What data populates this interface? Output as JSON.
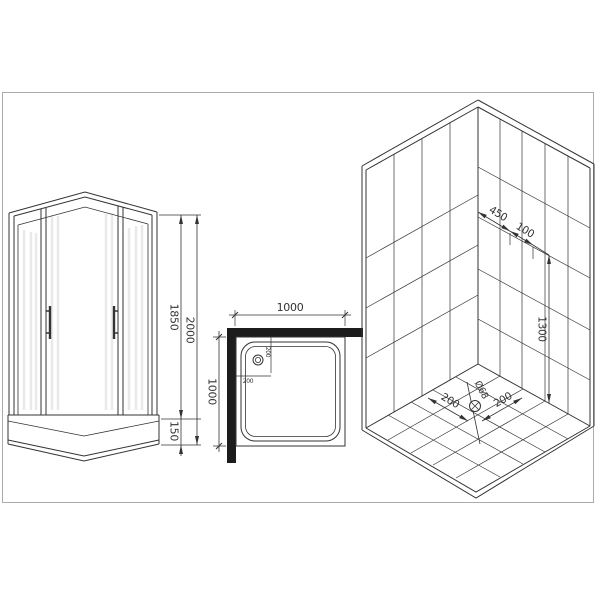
{
  "title": "Shower enclosure dimensional drawing",
  "front_view": {
    "total_height": "2000",
    "door_height": "1850",
    "tray_height": "150"
  },
  "plan_view": {
    "width": "1000",
    "depth": "1000",
    "drain_offset_top": "200",
    "drain_offset_left": "200"
  },
  "iso_view": {
    "wall_offset_a": "450",
    "wall_offset_b": "100",
    "fixture_height": "1300",
    "drain_from_left_wall": "200",
    "drain_from_right_wall": "200",
    "drain_diameter": "Ø68"
  },
  "colors": {
    "line": "#333333",
    "frame_border": "#ababab",
    "wall_fill": "#1c1c1c",
    "background": "#ffffff"
  }
}
